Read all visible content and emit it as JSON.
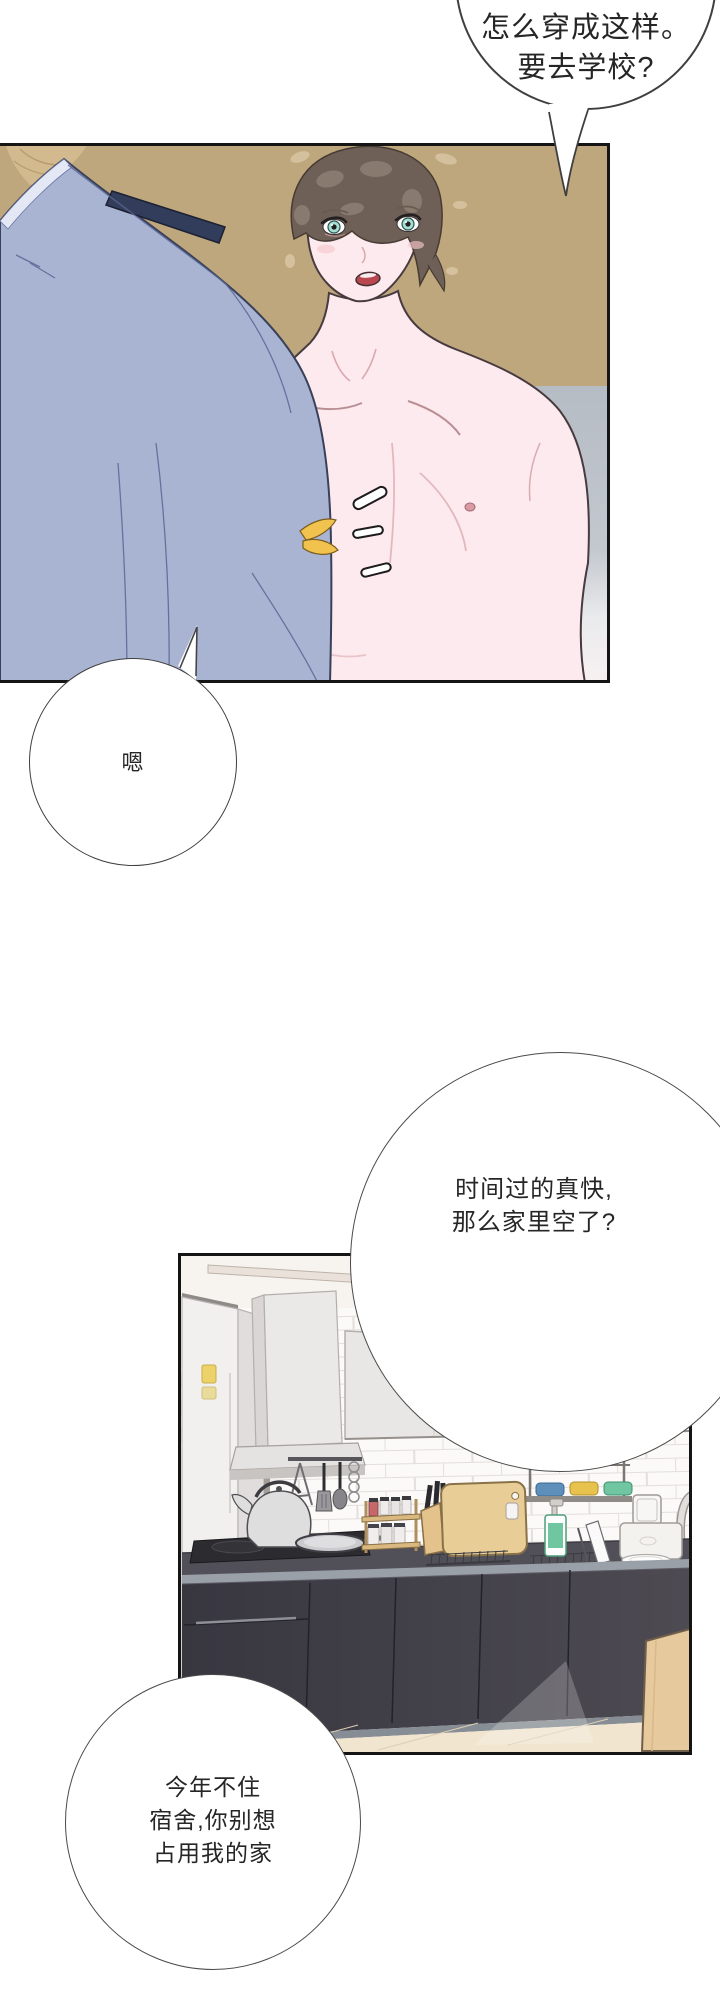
{
  "page": {
    "kind": "webtoon-comic-page",
    "panel1_description": "shirtless brown-haired young man facing a person in a light blue uniform shirt seen from behind, tan background",
    "panel2_description": "kitchen scene with fridge, range hood, cabinets, stove, kettle, pan, spice rack, cutting board, soap dispenser, toaster and dark lower cabinets"
  },
  "bubbles": {
    "top": {
      "lines": [
        "怎么穿成这样。",
        "要去学校?"
      ]
    },
    "reply": {
      "lines": [
        "嗯"
      ]
    },
    "middle": {
      "lines": [
        "时间过的真快,",
        "那么家里空了?"
      ]
    },
    "bottom": {
      "lines": [
        "今年不住",
        "宿舍,你别想",
        "占用我的家"
      ]
    }
  },
  "palette": {
    "panel_background_tan": "#bfa77d",
    "shirt_blue": "#a9b4d3",
    "epaulette_navy": "#323d5b",
    "skin_pink": "#fdeaee",
    "hair_brown": "#6e6057",
    "eye_teal": "#a7ddd2",
    "mouth_red": "#b9474f",
    "badge_gold": "#f1c24e",
    "gray_band": "#b6bcc4",
    "kitchen_counter_dark": "#44424b",
    "wood_tan": "#e6c99c",
    "bowl_blue": "#5d8fba",
    "bowl_yellow": "#e7c24c",
    "bowl_green": "#6fc6a0",
    "soap_green": "#70c6a0",
    "bubble_outline": "#3f3f3f"
  }
}
